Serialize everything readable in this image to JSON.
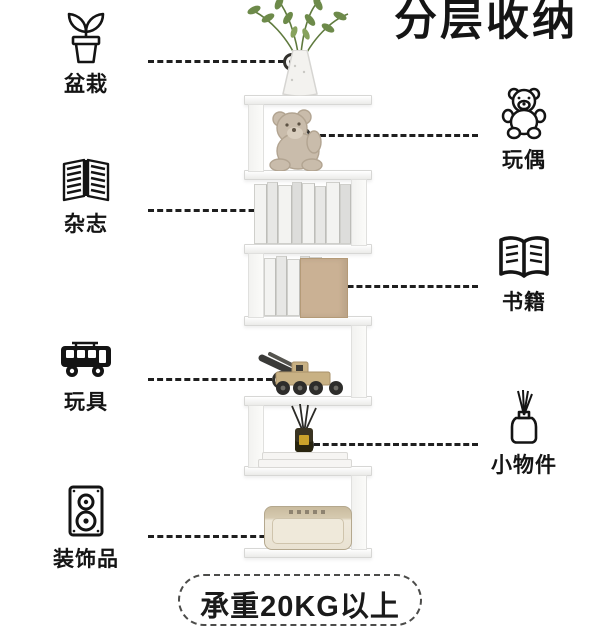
{
  "title": "分层收纳",
  "load_badge": {
    "text": "承重20KG以上"
  },
  "callouts": {
    "left": [
      {
        "label": "盆栽",
        "icon": "potted-plant-icon"
      },
      {
        "label": "杂志",
        "icon": "magazine-icon"
      },
      {
        "label": "玩具",
        "icon": "toy-bus-icon"
      },
      {
        "label": "装饰品",
        "icon": "speaker-icon"
      }
    ],
    "right": [
      {
        "label": "玩偶",
        "icon": "teddy-bear-icon"
      },
      {
        "label": "书籍",
        "icon": "open-book-icon"
      },
      {
        "label": "小物件",
        "icon": "reed-diffuser-icon"
      }
    ]
  },
  "shelf": {
    "tiers": [
      "potted-plant",
      "teddy-bear",
      "magazines",
      "books",
      "toy-truck",
      "reed-diffuser",
      "speaker"
    ]
  },
  "colors": {
    "text": "#151515",
    "line": "#1f1f1f",
    "tan": "#cab194",
    "plant_green": "#6d8a4a",
    "bear_beige": "#c9bcab",
    "speaker_cream": "#e9e2d2"
  }
}
